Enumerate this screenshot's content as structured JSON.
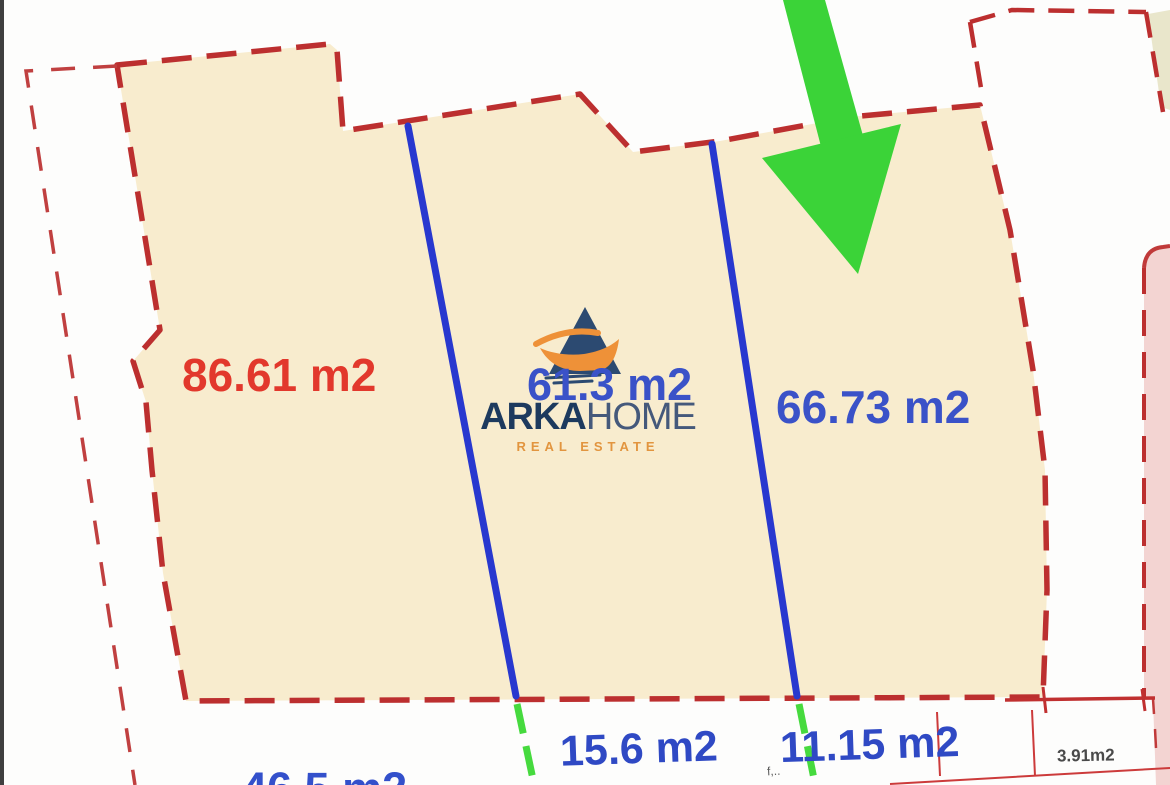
{
  "document": {
    "kind": "land parcel subdivision plan",
    "watermark": {
      "brand_primary": "ARKA",
      "brand_secondary": "HOME",
      "tagline": "REAL ESTATE"
    }
  },
  "plots": [
    {
      "id": "plot-1",
      "area_label": "86.61 m2",
      "label_color": "#e2382c"
    },
    {
      "id": "plot-2",
      "area_label": "61.3 m2",
      "label_color": "#3a52c8"
    },
    {
      "id": "plot-3",
      "area_label": "66.73 m2",
      "label_color": "#3a52c8"
    },
    {
      "id": "plot-bottom-left",
      "area_label": "46.5 m2",
      "label_color": "#3a52c8"
    },
    {
      "id": "plot-bottom-mid",
      "area_label": "15.6 m2",
      "label_color": "#3a52c8"
    },
    {
      "id": "plot-bottom-right",
      "area_label": "11.15 m2",
      "label_color": "#3a52c8"
    },
    {
      "id": "plot-small",
      "area_label": "3.91m2",
      "label_color": "#4a4a4a"
    }
  ],
  "annotations": {
    "tiny_note": "f,.."
  },
  "colors": {
    "parcel_fill": "#f8ecce",
    "parcel_fill_olive": "#e9e6cb",
    "parcel_fill_pink": "#f3d4d2",
    "boundary_red": "#bc2f2f",
    "divider_blue": "#2838cf",
    "accent_green": "#3ed13b",
    "area_text_blue": "#3a52c8",
    "area_text_red": "#e2382c"
  }
}
